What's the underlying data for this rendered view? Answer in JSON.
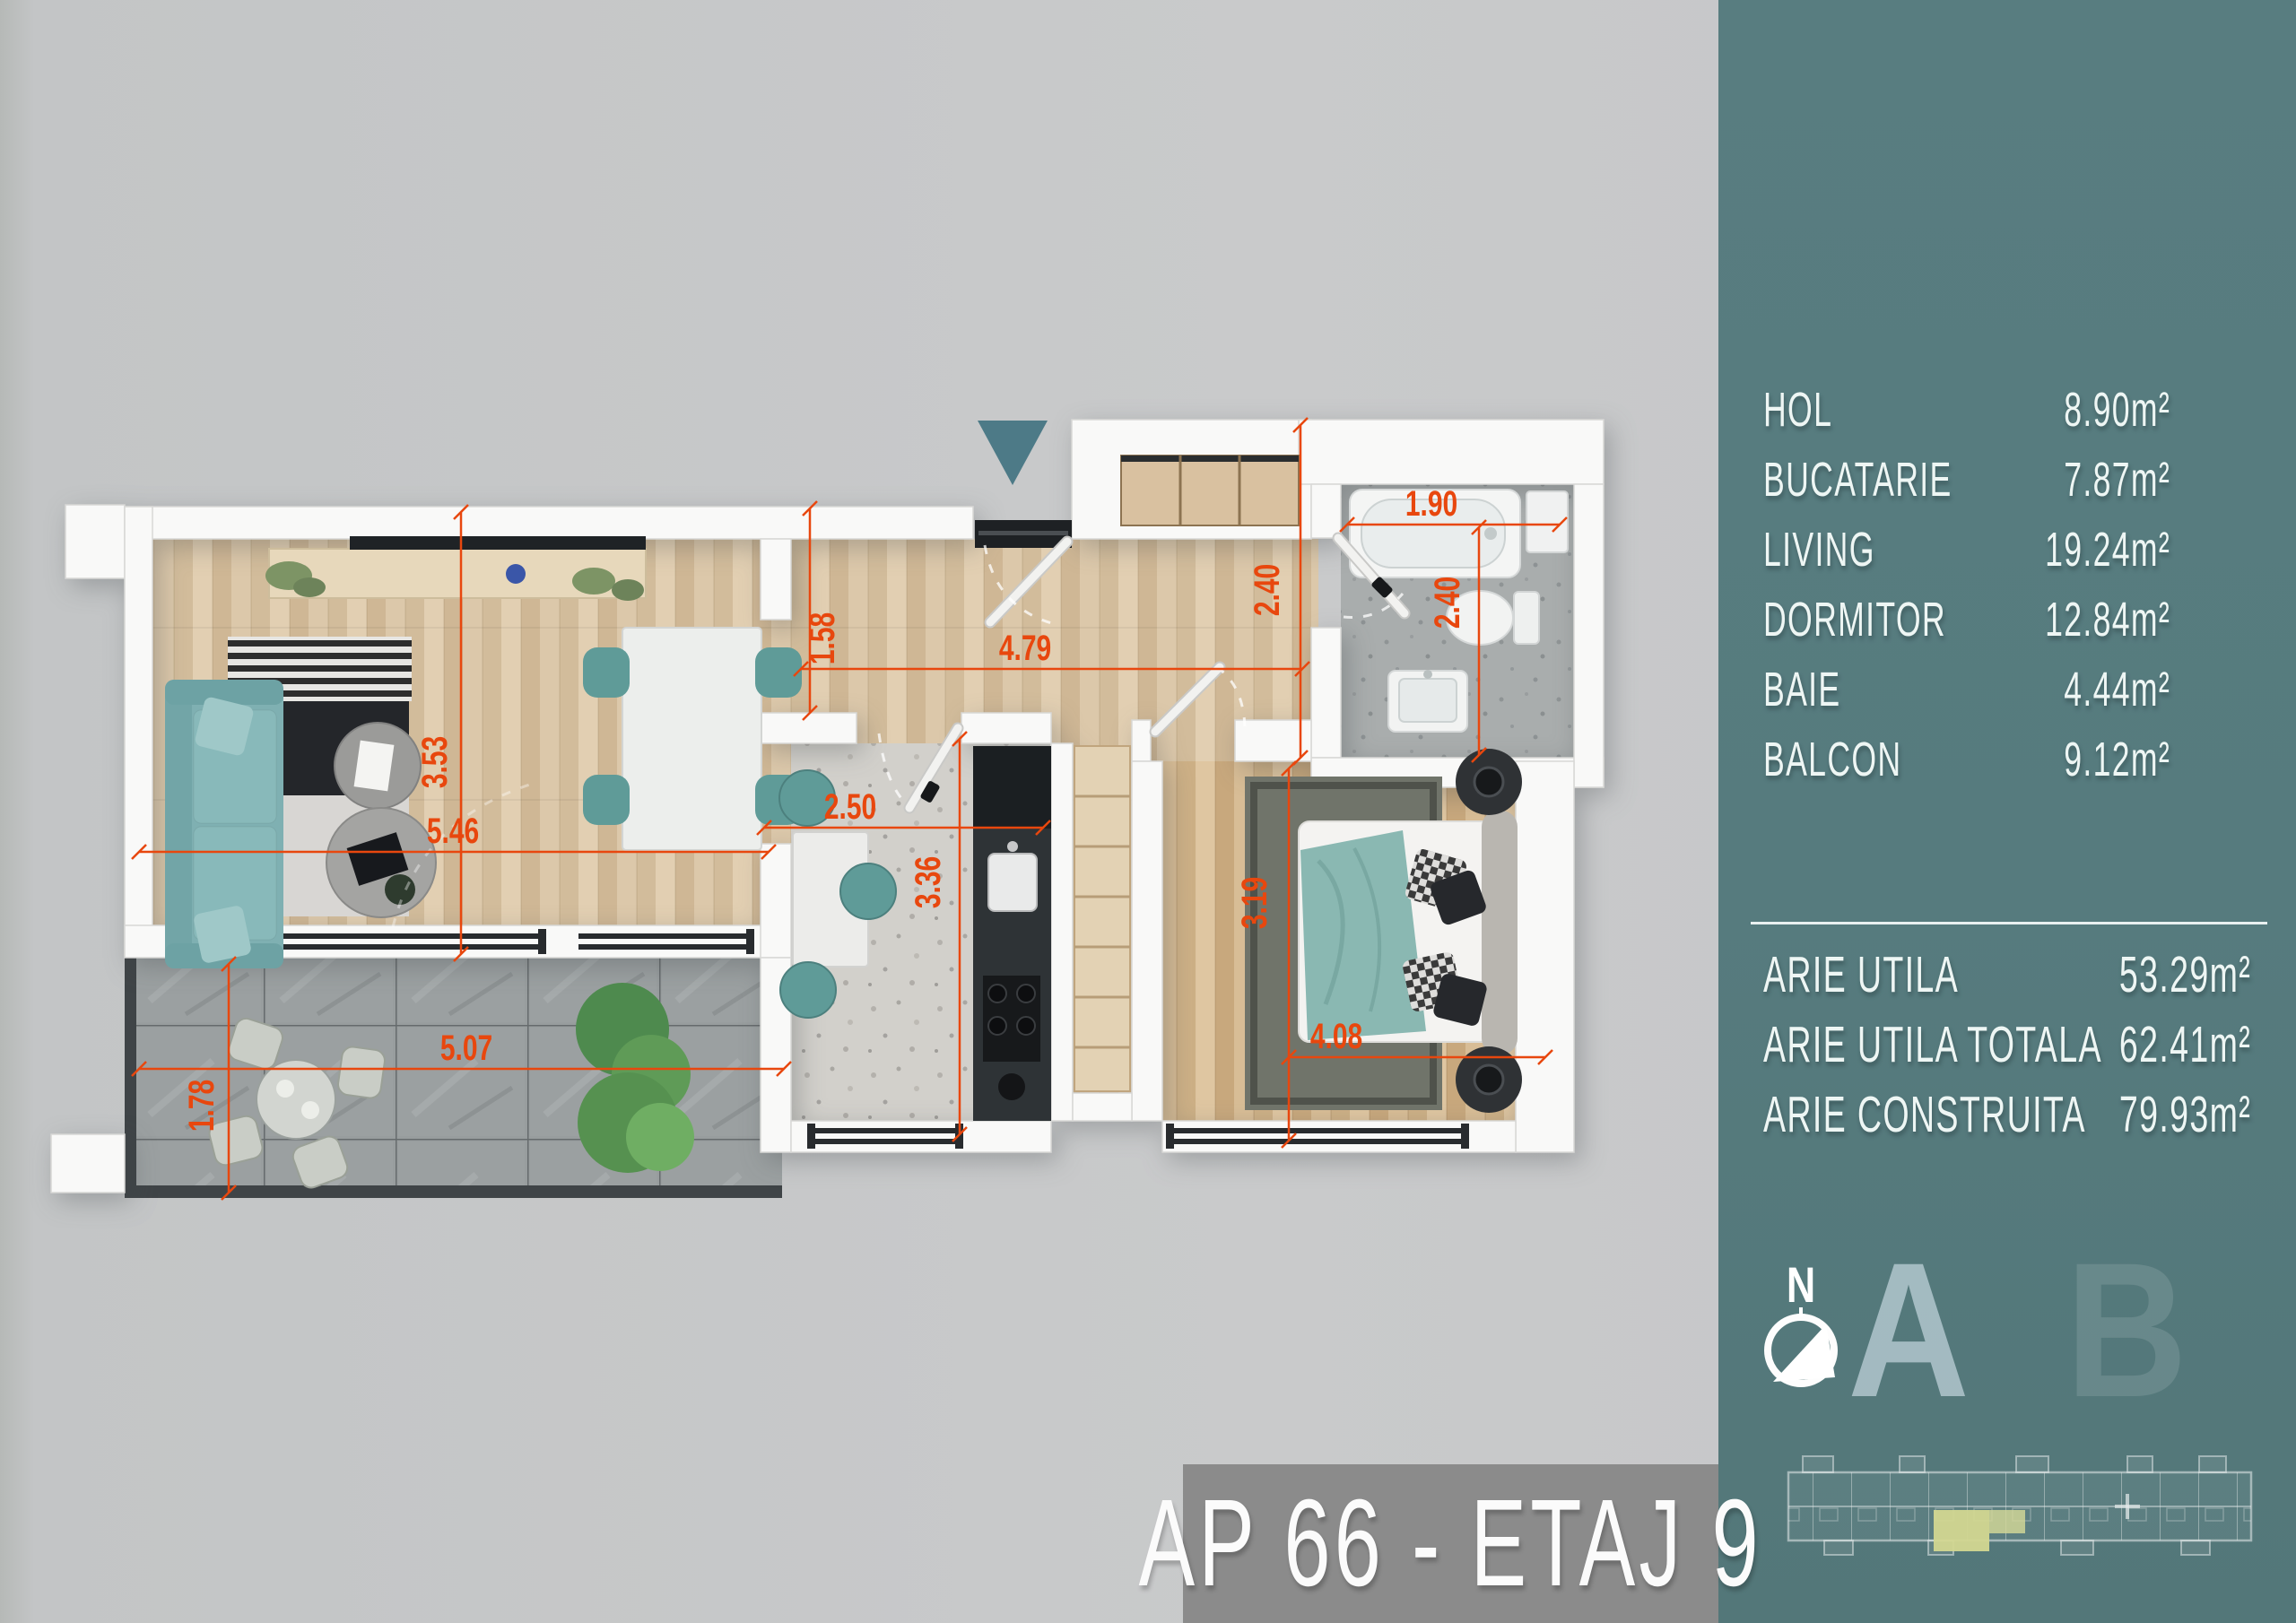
{
  "page": {
    "background_color": "#c9cacb"
  },
  "sidebar": {
    "bg_color": "#567b7e",
    "rooms": [
      {
        "label": "HOL",
        "area": "8.90m²"
      },
      {
        "label": "BUCATARIE",
        "area": "7.87m²"
      },
      {
        "label": "LIVING",
        "area": "19.24m²"
      },
      {
        "label": "DORMITOR",
        "area": "12.84m²"
      },
      {
        "label": "BAIE",
        "area": "4.44m²"
      },
      {
        "label": "BALCON",
        "area": "9.12m²"
      }
    ],
    "totals": [
      {
        "label": "ARIE UTILA",
        "value": "53.29m²"
      },
      {
        "label": "ARIE UTILA TOTALA",
        "value": "62.41m²"
      },
      {
        "label": "ARIE CONSTRUITA",
        "value": "79.93m²"
      }
    ],
    "compass_north_label": "N",
    "building_sections": {
      "a": "A",
      "b": "B"
    }
  },
  "title_bar": {
    "text": "AP 66 - ETAJ 9",
    "bg_color": "#8b8b8b"
  },
  "floor_plan": {
    "dimension_color": "#e8470e",
    "entrance_marker_color": "#4d7a87",
    "dims": [
      {
        "room": "living",
        "value": "3.53",
        "orientation": "vertical"
      },
      {
        "room": "living",
        "value": "5.46",
        "orientation": "horizontal"
      },
      {
        "room": "balcon",
        "value": "5.07",
        "orientation": "horizontal"
      },
      {
        "room": "balcon",
        "value": "1.78",
        "orientation": "vertical"
      },
      {
        "room": "hol",
        "value": "1.58",
        "orientation": "vertical"
      },
      {
        "room": "hol",
        "value": "4.79",
        "orientation": "horizontal"
      },
      {
        "room": "hol",
        "value": "2.40",
        "orientation": "vertical"
      },
      {
        "room": "bucatarie",
        "value": "2.50",
        "orientation": "horizontal"
      },
      {
        "room": "bucatarie",
        "value": "3.36",
        "orientation": "vertical"
      },
      {
        "room": "baie",
        "value": "1.90",
        "orientation": "horizontal"
      },
      {
        "room": "baie",
        "value": "2.40",
        "orientation": "vertical"
      },
      {
        "room": "dormitor",
        "value": "3.19",
        "orientation": "vertical"
      },
      {
        "room": "dormitor",
        "value": "4.08",
        "orientation": "horizontal"
      }
    ]
  }
}
